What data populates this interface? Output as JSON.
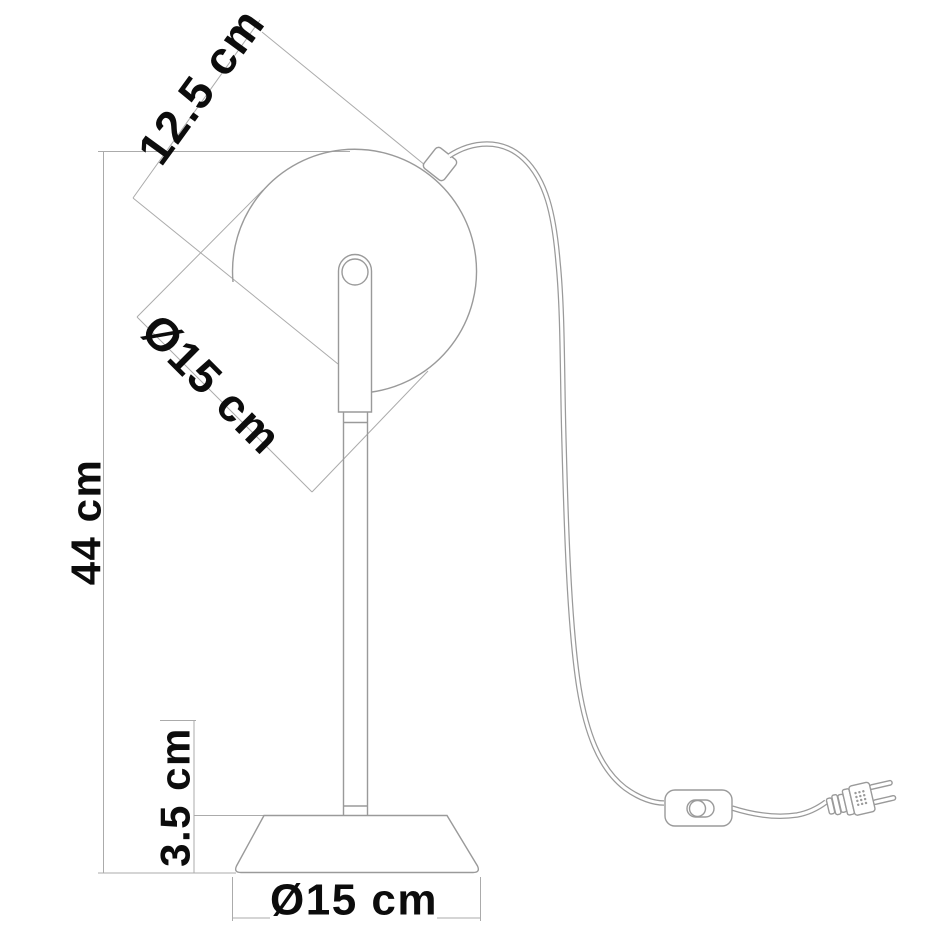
{
  "page": {
    "background": "#ffffff",
    "line_color": "#9a9a9a",
    "label_color": "#0c0c0c"
  },
  "diagram": {
    "type": "product-dimension-drawing",
    "subject": "desk lamp: spherical shade on stem with round base, power cord, inline switch, two-prong plug",
    "labels": {
      "head_depth": "12.5 cm",
      "head_opening_diameter": "Ø15 cm",
      "total_height": "44 cm",
      "base_height": "3.5 cm",
      "base_diameter": "Ø15 cm"
    }
  }
}
